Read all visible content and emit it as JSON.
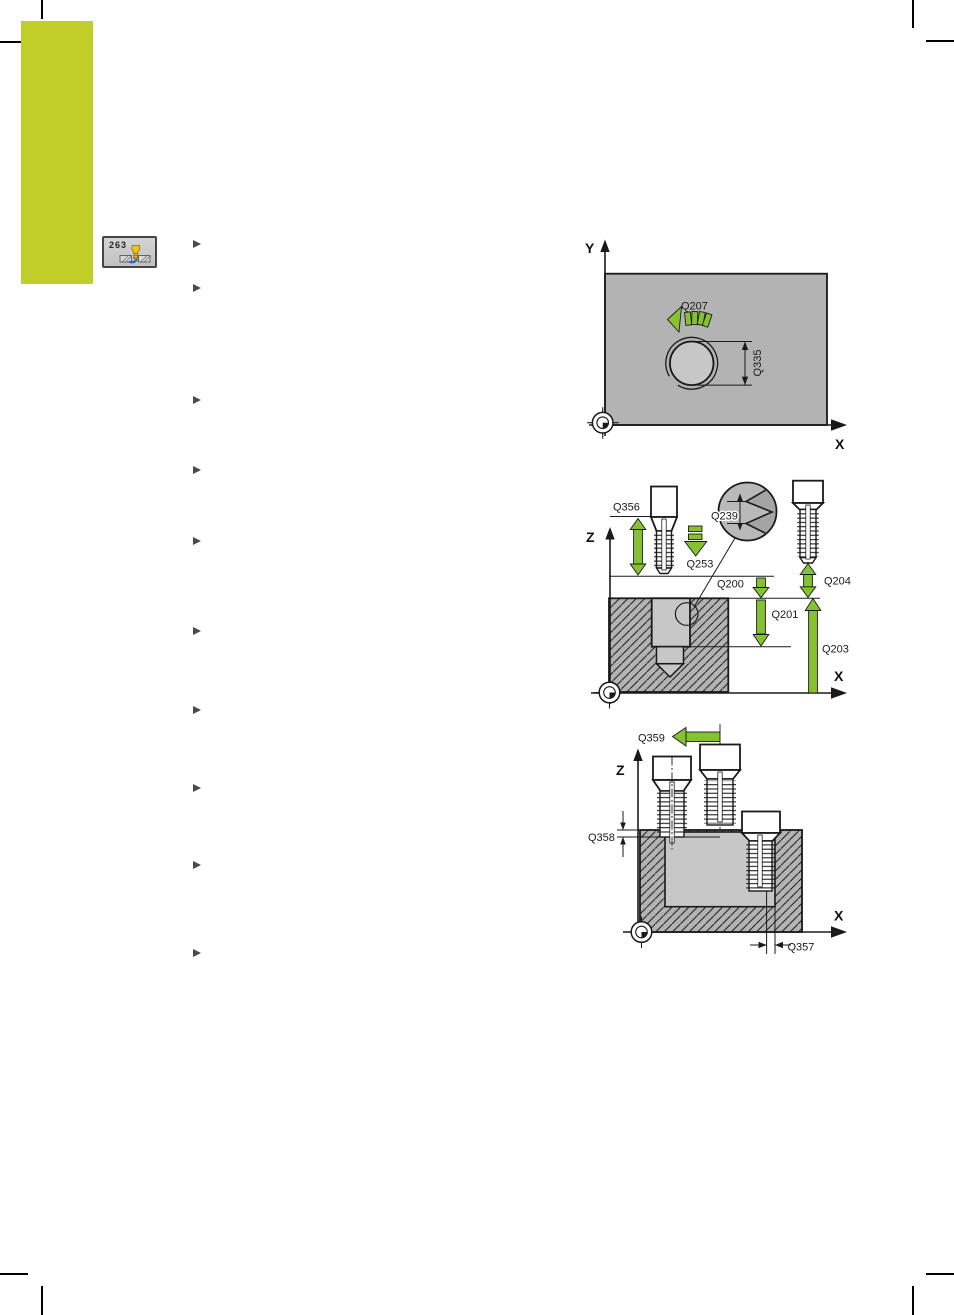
{
  "softkey": {
    "cycle_number": "263",
    "icon": "thread-mill-countersink-icon"
  },
  "bullet_list": {
    "marker": "right-triangle-icon",
    "count": 10
  },
  "colors": {
    "tab_green": "#c1cd29",
    "arrow_green": "#85c232",
    "workpiece_gray": "#b3b3b3",
    "pocket_gray": "#c7c7c7",
    "detail_gray": "#b9b9b9",
    "line_black": "#1a1a1a",
    "bullet_gray": "#4a4a4a"
  },
  "diagram_top_view": {
    "axis": {
      "x": "X",
      "y": "Y"
    },
    "labels": {
      "q207": "Q207",
      "q335": "Q335"
    }
  },
  "diagram_section": {
    "axis": {
      "z": "Z",
      "x": "X"
    },
    "labels": {
      "q356": "Q356",
      "q253": "Q253",
      "q239": "Q239",
      "q200": "Q200",
      "q201": "Q201",
      "q204": "Q204",
      "q203": "Q203"
    }
  },
  "diagram_front": {
    "axis": {
      "z": "Z",
      "x": "X"
    },
    "labels": {
      "q359": "Q359",
      "q358": "Q358",
      "q357": "Q357"
    }
  }
}
